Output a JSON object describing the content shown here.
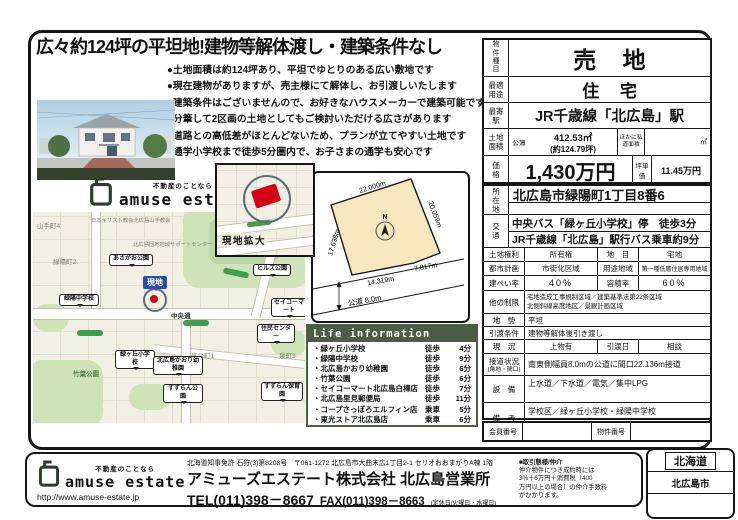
{
  "headline": "広々約124坪の平坦地!建物等解体渡し・建築条件なし",
  "bullets": [
    "●土地面積は約124坪あり、平坦でゆとりのある広い敷地です",
    "●現在建物がありますが、売主様にて解体し、お引渡しいたします",
    "●建築条件はございませんので、お好きなハウスメーカーで建築可能です",
    "●分筆して2区画の土地としてもご検討いただける広さがあります",
    "●道路との高低差がほとんどないため、プランが立てやすい土地です",
    "●通学小学校まで徒歩5分圏内で、お子さまの通学も安心です"
  ],
  "logo": {
    "tagline": "不動産のことなら",
    "name": "amuse estate",
    "url": "http://www.amuse-estate.jp"
  },
  "map": {
    "inset_label": "現地拡大",
    "site_label": "現地",
    "road_label": "中央通",
    "areas": {
      "yamate": "山手町4",
      "ryokuyo2": "緑陽町2",
      "ryokuyo3": "緑陽町3",
      "takadai": "高台町1",
      "izumi": "泉町3",
      "chikuba_park": "竹葉公園"
    },
    "pois": {
      "church": "日本キリスト教会北広島山手教会",
      "support": "北広島団地地域サポートセンター"
    },
    "balloons": {
      "asagao": "あさがお公園",
      "ryokuyo_jhs": "緑陽中学校",
      "midorigaoka_es": "緑ヶ丘小学校",
      "kaori_kg": "北広島かおり幼稚園",
      "suzuran_park": "すずらん公園",
      "suzuran_nursery": "すずらん保育園",
      "hills_park": "ヒルズ公園",
      "seicomart": "セイコーマート",
      "community_center": "住民センター"
    }
  },
  "site_plan": {
    "north": "N",
    "dim_top": "22.000m",
    "dim_right": "20.059m",
    "dim_left": "17.638m",
    "dim_bottom_left": "14.319m",
    "dim_bottom_right": "7.817m",
    "road": "公道 8.0m"
  },
  "life_info": {
    "title": "Life information",
    "rows": [
      {
        "name": "・緑ヶ丘小学校",
        "mode": "徒歩",
        "time": "4分"
      },
      {
        "name": "・緑陽中学校",
        "mode": "徒歩",
        "time": "9分"
      },
      {
        "name": "・北広島かおり幼稚園",
        "mode": "徒歩",
        "time": "6分"
      },
      {
        "name": "・竹葉公園",
        "mode": "徒歩",
        "time": "6分"
      },
      {
        "name": "・セイコーマート北広島白樺店",
        "mode": "徒歩",
        "time": "7分"
      },
      {
        "name": "・北広島里見郵便局",
        "mode": "徒歩",
        "time": "11分"
      },
      {
        "name": "・コープさっぽろエルフィン店",
        "mode": "乗車",
        "time": "5分"
      },
      {
        "name": "・東光ストア北広島店",
        "mode": "乗車",
        "time": "6分"
      }
    ]
  },
  "spec": {
    "type_label": "物件種目",
    "type_value": "売 地",
    "use_label": "最適用途",
    "use_value": "住 宅",
    "station_label": "最寄駅",
    "station_value": "JR千歳線「北広島」駅",
    "area_label": "土地面積",
    "area_register_label": "公簿",
    "area_value": "412.53㎡",
    "area_tsubo": "(約124.79坪)",
    "area_other_label": "ほかに私道面積",
    "area_other_unit": "㎡",
    "price_label": "価格",
    "price_value": "1,430万円",
    "unit_price_label": "坪単価",
    "unit_price_value": "11.45万円",
    "address_label": "所在地",
    "address_value": "北広島市緑陽町1丁目8番6",
    "access_label": "交通",
    "access_line1": "中央バス「緑ヶ丘小学校」停　徒歩3分",
    "access_line2": "JR千歳線「北広島」駅行バス乗車約9分",
    "rows": [
      {
        "l1": "土地権利",
        "v1": "所有権",
        "l2": "地　目",
        "v2": "宅地"
      },
      {
        "l1": "都市計画",
        "v1": "市街化区域",
        "l2": "用途地域",
        "v2": "第一種低層住居専用地域"
      },
      {
        "l1": "建ぺい率",
        "v1": "40%",
        "l2": "容積率",
        "v2": "60%"
      },
      {
        "l1": "他の制限",
        "v1": "宅地造成工事規制区域／建築基準法第22条区域",
        "v2": "北側斜線高度地区／景観計画区域"
      },
      {
        "l1": "地　勢",
        "v1": "平坦"
      },
      {
        "l1": "引渡条件",
        "v1": "建物等解体後引き渡し"
      },
      {
        "l1": "現　況",
        "v1": "上物有",
        "l2": "引渡日",
        "v2": "相談"
      },
      {
        "l1": "接道状況",
        "l1b": "(角地・間口)",
        "v1": "南東側幅員8.0mの公道に間口22.136m接道"
      },
      {
        "l1": "設　備",
        "v1": "上水道／下水道／電気／集中LPG"
      },
      {
        "l1": "備　考",
        "v1": "学校区／緑ヶ丘小学校・緑陽中学校"
      }
    ],
    "member_label": "会員番号",
    "property_no_label": "物件番号"
  },
  "footer": {
    "license_line": "北海道知事免許 石狩(3)第8208号　〒061-1272 北広島市大曲末広1丁目2-1 セリオおおまがりA棟 1階",
    "company": "アミューズエステート株式会社 北広島営業所",
    "tel": "TEL(011)398－8667",
    "fax": "FAX(011)398－8663",
    "holiday_note": "(定休日/火曜日・水曜日)",
    "notice_title": "■取引態様/仲介",
    "notice_line1": "仲介物件につき成約時には",
    "notice_line2": "3%＋6万円＋消費税（400",
    "notice_line3": "万円以上の場合）の仲介手数料",
    "notice_line4": "がかかります。"
  },
  "region": {
    "pref": "北海道",
    "city": "北広島市"
  },
  "colors": {
    "frame_black": "#151515",
    "life_green": "#4b5d44",
    "site_red": "#d40014",
    "balloon_blue": "#2b4ea0",
    "parcel_cream": "#f7e8c0",
    "park_green": "#cfe3b8"
  }
}
